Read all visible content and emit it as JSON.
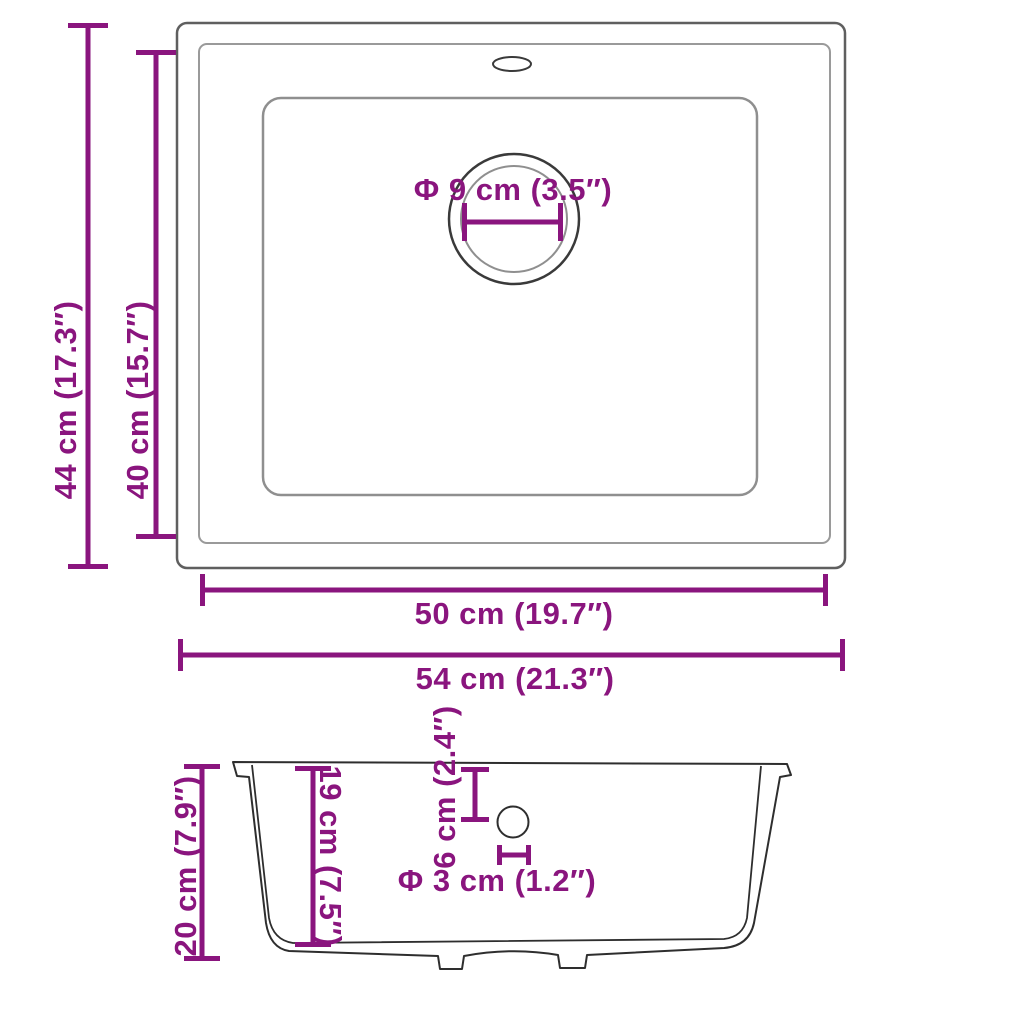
{
  "diagram_title": "Kitchen sink dimension diagram (top view and side view)",
  "colors": {
    "dimension": "#8A157E",
    "outline_dark": "#2E2E2E",
    "outline_mid": "#5F5F5F",
    "outline_light": "#9A9A9A",
    "background": "#FFFFFF"
  },
  "top_view": {
    "outer_height_label": "44 cm (17.3″)",
    "inner_height_label": "40 cm (15.7″)",
    "drain_diameter_label": "Φ 9 cm (3.5″)",
    "inner_width_label": "50 cm (19.7″)",
    "outer_width_label": "54 cm (21.3″)"
  },
  "side_view": {
    "overall_height_label": "20 cm (7.9″)",
    "bowl_depth_label": "19 cm (7.5″)",
    "drain_offset_label": "6 cm (2.4″)",
    "drain_hole_label": "Φ 3 cm (1.2″)"
  }
}
